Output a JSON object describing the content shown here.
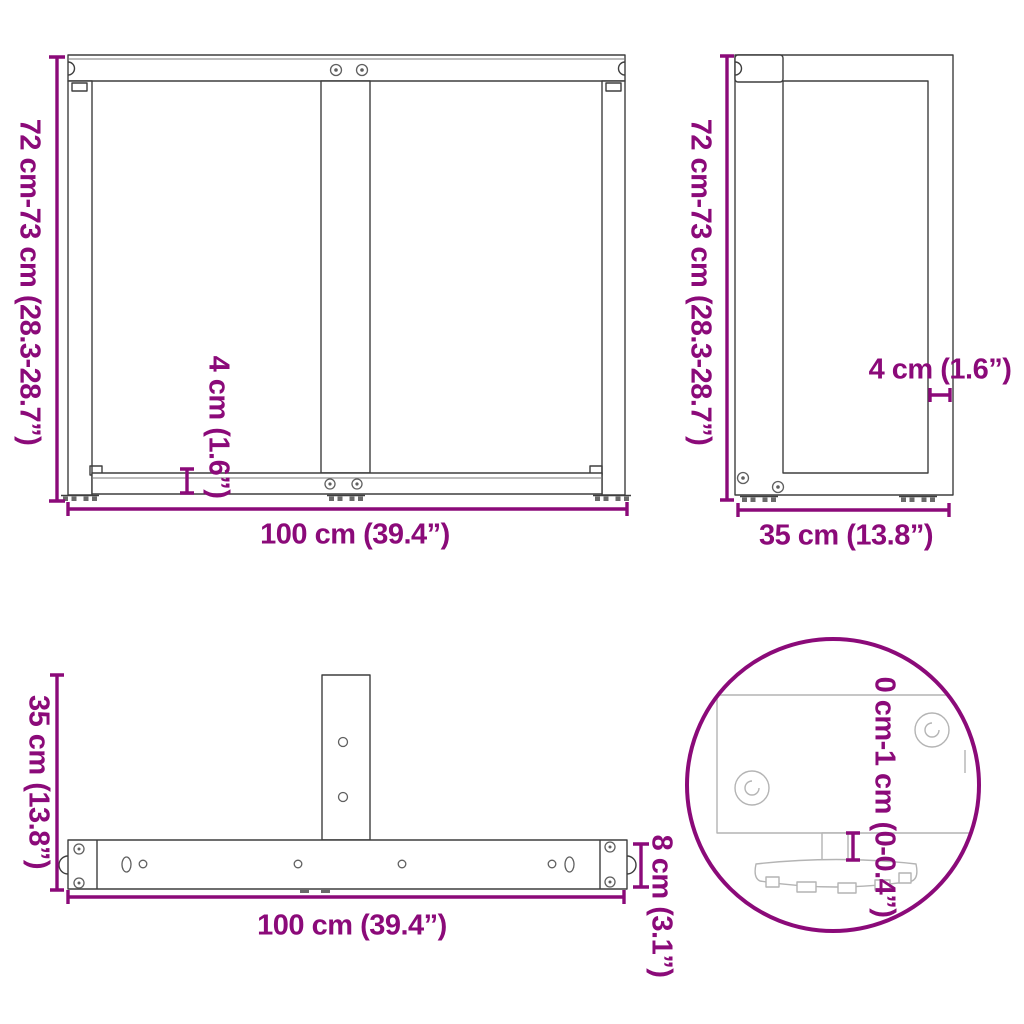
{
  "colors": {
    "dimension_accent": "#8B0A79",
    "drawing_line": "#3E3E3E",
    "detail_drawing_line": "#B4B4B4",
    "background": "#FFFFFF"
  },
  "views": {
    "front": {
      "height_label": "72 cm-73 cm (28.3-28.7”)",
      "width_label": "100 cm (39.4”)",
      "bottom_bar_label": "4 cm (1.6”)"
    },
    "side": {
      "height_label": "72 cm-73 cm (28.3-28.7”)",
      "depth_label": "35 cm (13.8”)",
      "profile_label": "4 cm (1.6”)"
    },
    "top": {
      "depth_label": "35 cm (13.8”)",
      "width_label": "100 cm (39.4”)",
      "bar_width_label": "8 cm (3.1”)"
    },
    "detail": {
      "height_adjustment_label": "0 cm-1 cm (0-0.4”)"
    }
  }
}
